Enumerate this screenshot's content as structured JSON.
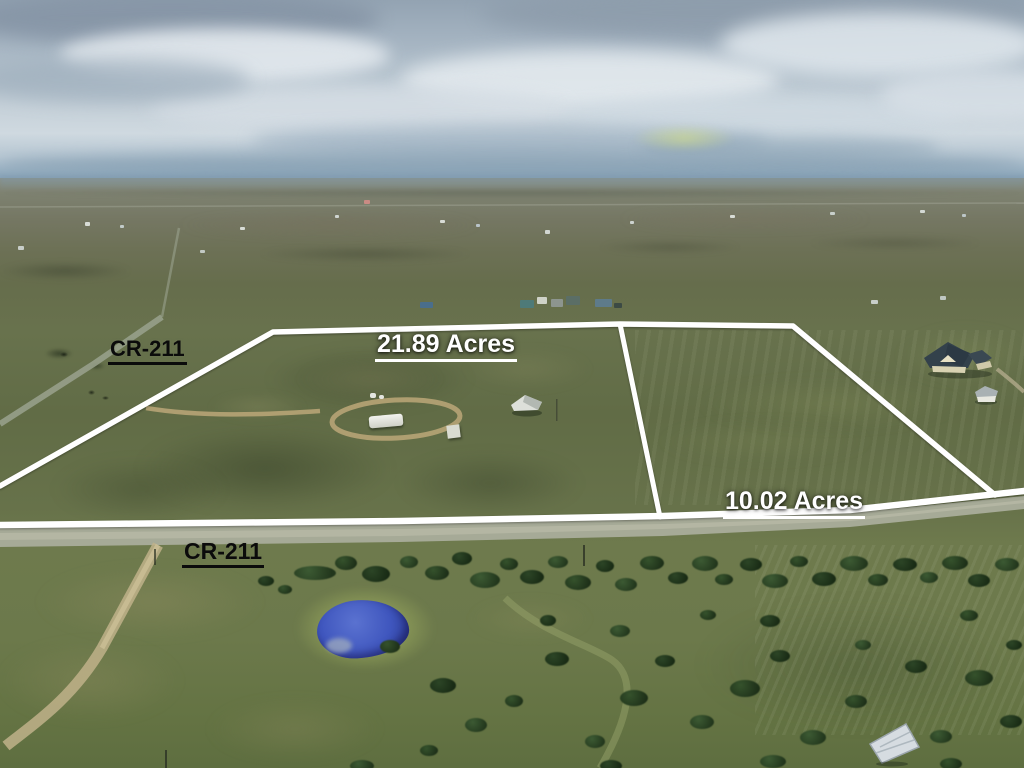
{
  "photo": {
    "kind": "aerial-drone-land-listing-photo",
    "boundary_color": "#ffffff",
    "parcel_label_color": "#ffffff",
    "road_label_color": "#0b0b0b"
  },
  "annotations": {
    "parcel_large_label": "21.89 Acres",
    "parcel_small_label": "10.02 Acres",
    "road_label_left": "CR-211",
    "road_label_bottom": "CR-211"
  }
}
